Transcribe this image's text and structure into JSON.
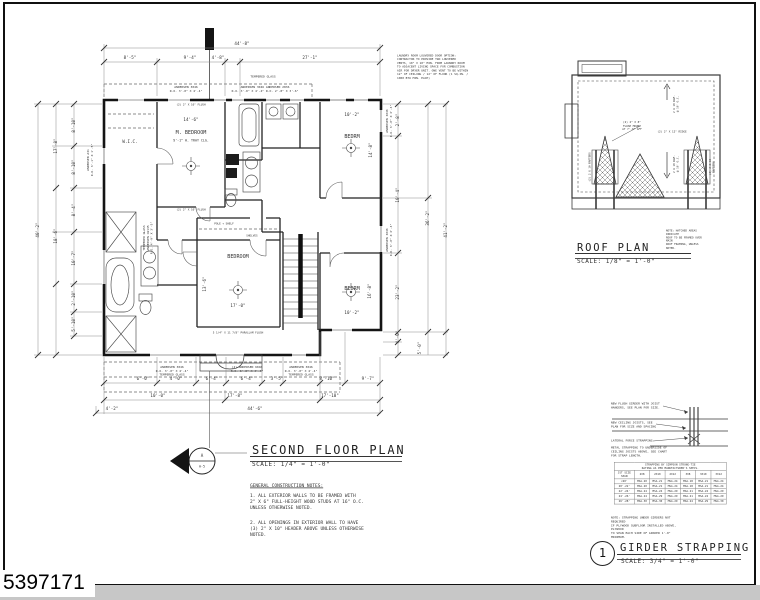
{
  "mls_number": "5397171",
  "floor_plan": {
    "title": "SECOND FLOOR PLAN",
    "scale": "SCALE: 1/4\" = 1'-0\"",
    "section_marker": {
      "letter": "A",
      "sheet": "A-5"
    },
    "notes_heading": "GENERAL CONSTRUCTION NOTES:",
    "note_1": "1. ALL EXTERIOR WALLS TO BE FRAMED WITH\n2\" X 6\" FULL-HEIGHT WOOD STUDS AT 16\" O.C.\nUNLESS OTHERWISE NOTED.",
    "note_2": "2. ALL OPENINGS IN EXTERIOR WALL TO HAVE\n(3) 2\" X 10\" HEADER ABOVE UNLESS OTHERWISE\nNOTED.",
    "laundry_note": "LAUNDRY ROOM LOUVERED DOOR OPTION:\nCONTRACTOR TO PROVIDE TWO LOUVERED\nVENTS, 10\" X 10\" MIN. FROM LAUNDRY ROOM\nTO ADJACENT LIVING SPACE FOR COMBUSTION\nAIR FOR DRYER UNIT. ONE VENT TO BE WITHIN\n12\" OF CEILING / 12\" OF FLOOR (1 SQ.IN. /\n1000 BTU MIN. EACH)",
    "rooms": {
      "master_bedroom": "M. BEDROOM",
      "master_ceiling": "9'-1\" H. TRAY CLG.",
      "wic": "W.I.C.",
      "bedroom_top_right": "BEDRM",
      "bedroom_center": "BEDROOM",
      "bedroom_bottom_right": "BEDRM"
    },
    "room_dims": {
      "master_w": "14'-6\"",
      "tr_w": "10'-2\"",
      "tr_h": "14'-8\"",
      "center_w": "17'-0\"",
      "center_h": "13'-6\"",
      "br_w": "10'-2\"",
      "br_h": "16'-8\""
    },
    "interior_labels": {
      "pole_shelf": "POLE + SHELF",
      "shelves": "SHELVES",
      "flush_header_top": "(2) 2\" X 10\" FLUSH",
      "flush_header_master": "(2) 2\" X 10\" FLUSH",
      "parallam_beam": "5 1/4\" X 11 7/8\" PARALLAM FLUSH"
    },
    "window_labels": {
      "tempered": "TEMPERED GLASS",
      "top_a": "ANDERSEN 3046\nR.O. 3'-0\" X 4'-4\"",
      "top_b": "ANDERSEN 3046  ANDERSEN 2836\nR.O. 3'-0\" X 4'-4\"  R.O. 2'-8\" X 3'-6\"",
      "left_a": "ANDERSEN A31\nR.O. 3'-1\" X 1'-5\"",
      "left_b": "TEMPERED GLASS\nANDERSEN CW135\nR.O. 4'-9\" X 3'-5\"",
      "right_a": "ANDERSEN 3046\nR.O. 3'-0\" X 4'-4\"",
      "right_b": "ANDERSEN 3046\nR.O. 3'-0\" X 4'-4\"",
      "bottom_a": "ANDERSEN 3046\nR.O. 3'-0\" X 4'-4\"\nTEMPERED GLASS",
      "bottom_b": "(2) ANDERSEN 6046\nR.O. 6'-0\" X 4'-4\"",
      "bottom_c": "ANDERSEN 3046\nR.O. 3'-0\" X 4'-4\"\nTEMPERED GLASS"
    },
    "dims": {
      "top": [
        "44'-8\"",
        "8'-5\"",
        "9'-4\"",
        "4'-8\"",
        "27'-1\""
      ],
      "left": [
        "40'-2\"",
        "17'-8\"",
        "18'-6\"",
        "8'-10\"",
        "8'-10\"",
        "8'-4\"",
        "10'-7\"",
        "2'-10\"",
        "5'-10\""
      ],
      "right": [
        "2'-8\"",
        "10'-4\"",
        "23'-2\"",
        "36'-2\"",
        "41'-2\"",
        "4'-0\"",
        "5'-0\""
      ],
      "bottom": [
        "6'-0\"",
        "4'-0\"",
        "6'-4\"",
        "6'-4\"",
        "3'-5\"",
        "8'-10\"",
        "9'-7\"",
        "10'-0\"",
        "17'-8\"",
        "17'-10\"",
        "4'-2\"",
        "44'-6\""
      ]
    }
  },
  "roof_plan": {
    "title": "ROOF PLAN",
    "scale": "SCALE: 1/8\" = 1'-0\"",
    "note": "NOTE: HATCHED AREAS INDICATE\nROOF TO BE FRAMED OVER MAIN\nROOF FRAMING, UNLESS NOTED.",
    "labels": {
      "flush_mount": "(2) 2\" X 8\"\nFLUSH MOUNT\nAT 7'-0\" AFF",
      "ridge": "(2) 2\" X 12\" RIDGE",
      "rafters_upper": "2 X 10 RAF.\n@ 16\" O.C.",
      "rafters_lower": "2 X 10 RAF.\n@ 16\" O.C.",
      "dormer_left": "(2) 2 X 10 RAFTERS",
      "dormer_right": "(2) 2 X 10 RAFTERS"
    }
  },
  "girder_detail": {
    "number": "1",
    "title": "GIRDER STRAPPING",
    "scale": "SCALE: 3/4\" = 1'-0\"",
    "callout_girder": "NEW FLUSH GIRDER WITH JOIST\nHANGERS, SEE PLAN FOR SIZE.",
    "callout_joists": "NEW CEILING JOISTS, SEE\nPLAN FOR SIZE AND SPACING",
    "callout_strap": "LATERAL FORCE STRAPPING",
    "callout_metal": "METAL STRAPPING TO UNDERSIDE OF\nCEILING JOISTS ABOVE, SEE CHART\nFOR STRAP LENGTH.",
    "note": "NOTE: STRAPPING UNDER GIRDERS NOT REQUIRED\nIF PLYWOOD SUBFLOOR INSTALLED ABOVE, PLYWOOD\nTO SPAN EACH SIDE OF GIRDER 1'-0\" MINIMUM.",
    "table": {
      "caption": "STRAPPING BY SIMPSON STRONG-TIE\nRATING AS PER MANUFACTURER'S SPECS.",
      "headers": [
        "JST SIZE\nSPAN",
        "2X8",
        "2X10",
        "2X12",
        "3X8",
        "3X10",
        "3X12"
      ],
      "rows": [
        [
          "<20'",
          "MSA-20",
          "MSA-21",
          "MSA-24",
          "MSA-18",
          "MSA-21",
          "MSA-24"
        ],
        [
          "20'-22'",
          "MSA-20",
          "MSA-21",
          "MSA-24",
          "MSA-18",
          "MSA-21",
          "MSA-24"
        ],
        [
          "22'-24'",
          "MSA-24",
          "MSA-24",
          "MSA-29",
          "MSA-21",
          "MSA-24",
          "MSA-29"
        ],
        [
          "24'-26'",
          "MSA-24",
          "MSA-29",
          "MSA-29",
          "MSA-21",
          "MSA-24",
          "MSA-29"
        ],
        [
          "26'-28'",
          "MSA-30",
          "MSA-30",
          "MSA-29",
          "MSA-24",
          "MSA-29",
          "MSA-30"
        ]
      ]
    }
  }
}
